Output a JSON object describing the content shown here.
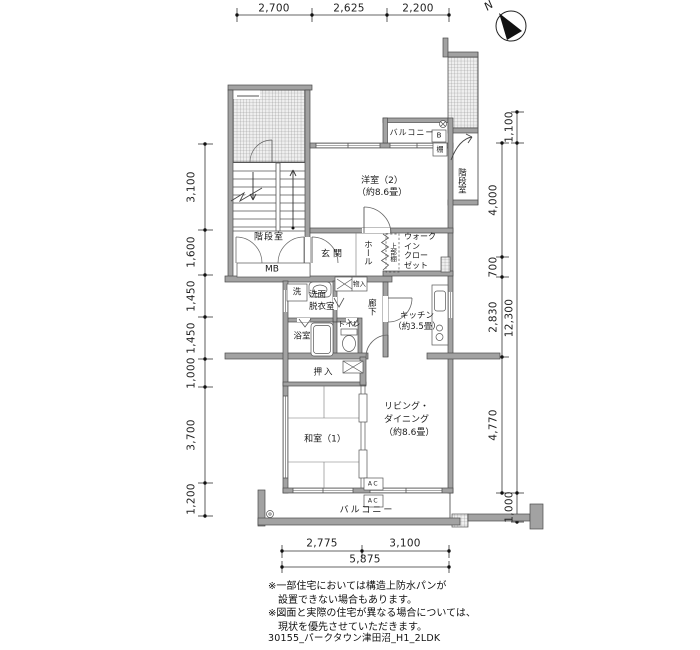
{
  "compass": {
    "north": "N"
  },
  "dims": {
    "top": [
      "2,700",
      "2,625",
      "2,200"
    ],
    "left": [
      "3,100",
      "1,600",
      "1,450",
      "1,450",
      "1,000",
      "3,700",
      "1,200"
    ],
    "right_inner": [
      "4,000",
      "700",
      "2,830",
      "4,770"
    ],
    "right_outer": [
      "1,100",
      "12,300",
      "1,000"
    ],
    "bottom": [
      "2,775",
      "3,100"
    ],
    "bottom_total": "5,875"
  },
  "rooms": {
    "western2": "洋室（2）\n（約8.6畳）",
    "living": "リビング・\nダイニング\n（約8.6畳）",
    "japanese1": "和室（1）",
    "kitchen": "キッチン\n（約3.5畳）",
    "genkan": "玄関",
    "hall": "ホール",
    "wic": "ウォーク\nイン\nクロー\nゼット",
    "upper_shelf": "上部棚",
    "corridor": "廊下",
    "washroom": "洗面\n脱衣室",
    "washer": "洗",
    "bath": "浴室",
    "toilet": "トイレ",
    "oshiire": "押入",
    "monoire": "物入",
    "stair_left": "階段室",
    "stair_right": "階段室",
    "balcony_top": "バルコニー",
    "balcony_bottom": "バルコニー"
  },
  "boxes": {
    "mb": "MB",
    "b": "B",
    "shelf": "棚",
    "ac": "AC"
  },
  "footer": {
    "notes": "※一部住宅においては構造上防水パンが\n　設置できない場合もあります。\n※図面と実際の住宅が異なる場合については、\n　現状を優先させていただきます。",
    "code": "30155_パークタウン津田沼_H1_2LDK"
  }
}
